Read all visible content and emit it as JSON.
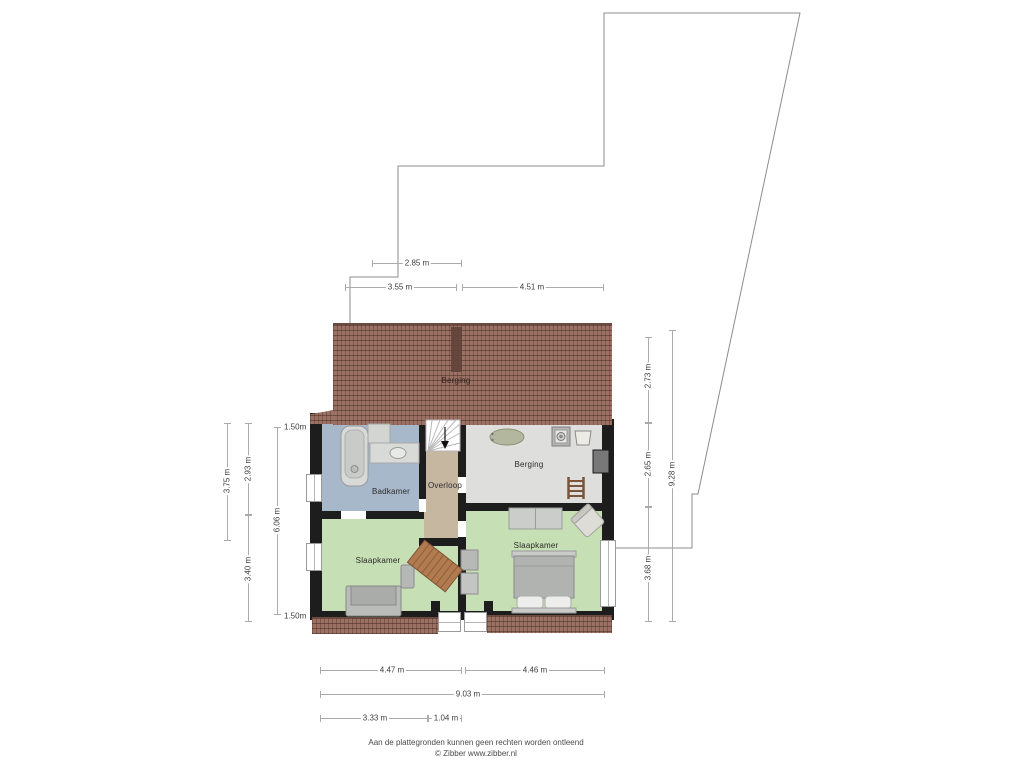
{
  "rooms": {
    "roof_berging": "Berging",
    "badkamer": "Badkamer",
    "overloop": "Overloop",
    "berging": "Berging",
    "slaapkamer_left": "Slaapkamer",
    "slaapkamer_right": "Slaapkamer"
  },
  "dimensions": {
    "top": {
      "w285": "2.85 m",
      "w355": "3.55 m",
      "w451": "4.51 m"
    },
    "left": {
      "h375": "3.75 m",
      "h293": "2.93 m",
      "h340": "3.40 m",
      "h606": "6.06 m",
      "knee_top": "1.50m",
      "knee_bottom": "1.50m"
    },
    "right": {
      "h273": "2.73 m",
      "h265": "2.65 m",
      "h368": "3.68 m",
      "h928": "9.28 m"
    },
    "bottom": {
      "w447": "4.47 m",
      "w446": "4.46 m",
      "w903": "9.03 m",
      "w333": "3.33 m",
      "w104": "1.04 m"
    }
  },
  "footer": {
    "disclaimer": "Aan de plattegronden kunnen geen rechten worden ontleend",
    "credit": "© Zibber www.zibber.nl"
  },
  "icons": {
    "stairs-icon": "white fan-tread staircase with down arrow",
    "stairs-arrow-icon": "▼",
    "bathtub-icon": "rounded rectangle tub with drain",
    "shower-icon": "small gray square",
    "washbasin-icon": "counter with oval basin",
    "oval-tub-icon": "sage green oval",
    "washing-machine-icon": "square with circle drum",
    "laundry-basket-icon": "trapezoid basket",
    "ladder-icon": "two rails with rungs",
    "bed-icon": "mattress with two pillows",
    "sofa-icon": "gray couch",
    "desk-icon": "rotated wooden table",
    "chair-icon": "rotated seat",
    "wardrobe-icon": "gray cabinet",
    "chimney-icon": "dark block",
    "window-icon": "white bar with frame line"
  },
  "colors": {
    "roof": "#9b7164",
    "roof_ridge": "#6b4a40",
    "chimney": "#5f4338",
    "wall": "#1d1d1d",
    "badkamer_floor": "#a7b8ca",
    "overloop_floor": "#c6b7a0",
    "berging_floor": "#dededc",
    "slaapkamer_floor": "#c7dfb4",
    "boundary_line": "#8c8c8c",
    "dimension_line": "#ababab",
    "text": "#3d3d3d"
  }
}
